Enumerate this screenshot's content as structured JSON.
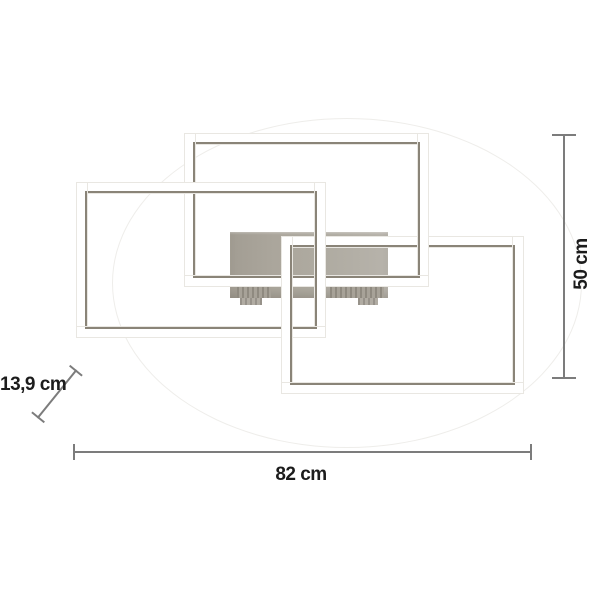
{
  "diagram": {
    "labels": {
      "width": "82 cm",
      "height": "50 cm",
      "depth": "13,9 cm"
    }
  },
  "colors": {
    "background": "#ffffff",
    "frame_fill": "#ffffff",
    "frame_accent_line": "#8a8478",
    "mounting_plate": "#aba69c",
    "dimension_line": "#7c7c7c",
    "label_text": "#1c1c1c"
  }
}
